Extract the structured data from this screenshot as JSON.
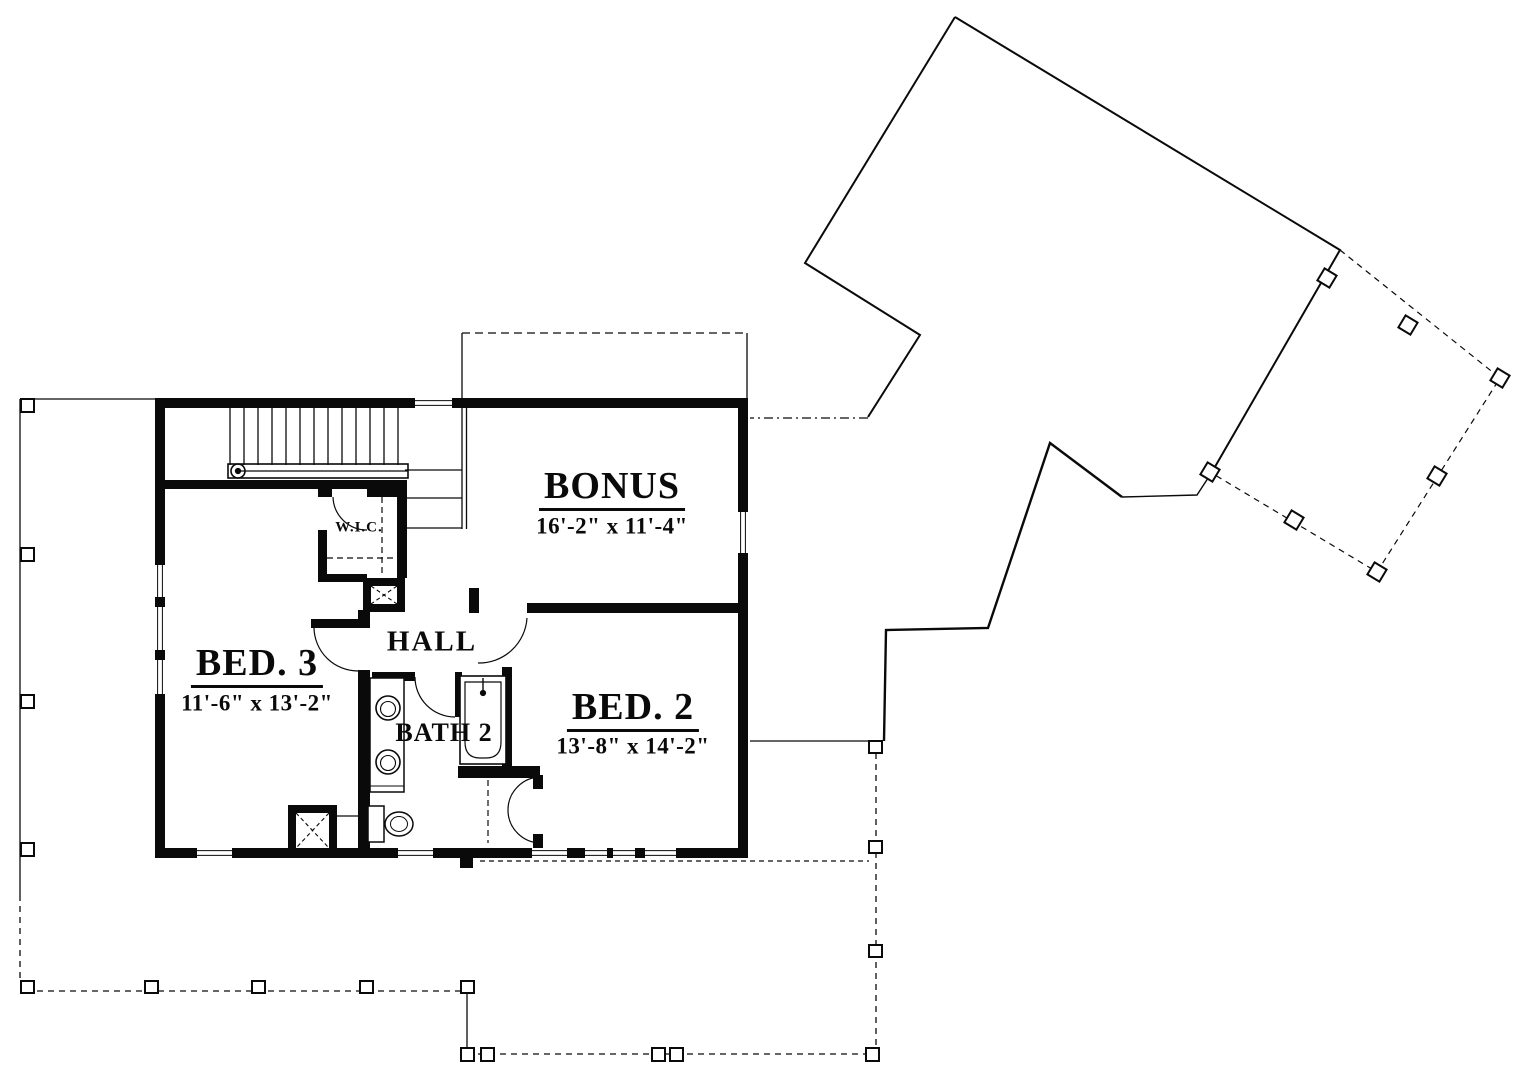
{
  "plan": {
    "rooms": {
      "bonus": {
        "name": "BONUS",
        "dimensions": "16'-2\" x 11'-4\""
      },
      "bed2": {
        "name": "BED. 2",
        "dimensions": "13'-8\" x 14'-2\""
      },
      "bed3": {
        "name": "BED. 3",
        "dimensions": "11'-6\" x 13'-2\""
      },
      "hall": {
        "name": "HALL"
      },
      "bath2": {
        "name": "BATH 2"
      },
      "wic": {
        "name": "W.I.C."
      }
    },
    "colors": {
      "line": "#0a0a0a",
      "background": "#ffffff"
    }
  }
}
